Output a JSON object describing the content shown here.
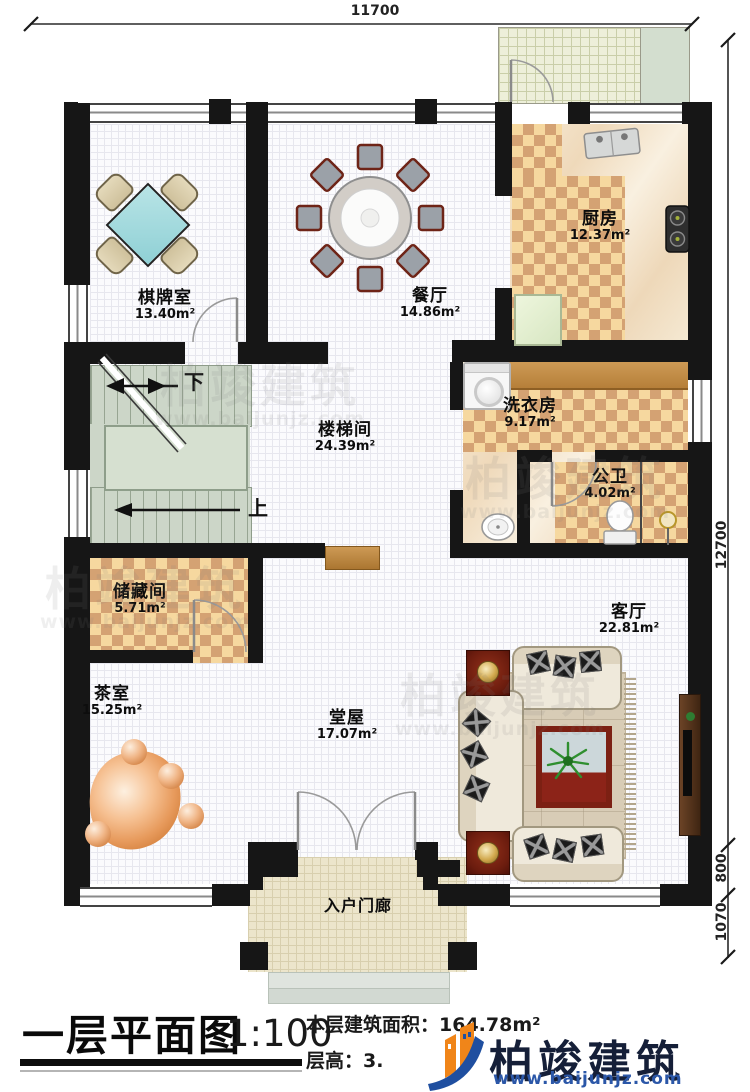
{
  "plan": {
    "rooms": [
      {
        "id": "chess",
        "name": "棋牌室",
        "area": "13.40m²"
      },
      {
        "id": "dining",
        "name": "餐厅",
        "area": "14.86m²"
      },
      {
        "id": "kitchen",
        "name": "厨房",
        "area": "12.37m²"
      },
      {
        "id": "laundry",
        "name": "洗衣房",
        "area": "9.17m²"
      },
      {
        "id": "bath",
        "name": "公卫",
        "area": "4.02m²"
      },
      {
        "id": "stairhall",
        "name": "楼梯间",
        "area": "24.39m²"
      },
      {
        "id": "storage",
        "name": "储藏间",
        "area": "5.71m²"
      },
      {
        "id": "tea",
        "name": "茶室",
        "area": "15.25m²"
      },
      {
        "id": "hall",
        "name": "堂屋",
        "area": "17.07m²"
      },
      {
        "id": "living",
        "name": "客厅",
        "area": "22.81m²"
      },
      {
        "id": "porch",
        "name": "入户门廊",
        "area": ""
      }
    ],
    "stair_marks": {
      "down": "下",
      "up": "上"
    },
    "dimensions": {
      "top": "11700",
      "right_main": "12700",
      "right_mid": "800",
      "right_bottom": "1070"
    }
  },
  "titleblock": {
    "title": "一层平面图",
    "scale": "1:100",
    "area_label": "本层建筑面积：",
    "area_value": "164.78m²",
    "height_label": "层高：",
    "height_value": "3."
  },
  "brand": {
    "name": "柏竣建筑",
    "url": "www.baijunjz.com"
  },
  "watermark": {
    "text": "柏竣建筑",
    "url": "www.baijunjz.com"
  }
}
